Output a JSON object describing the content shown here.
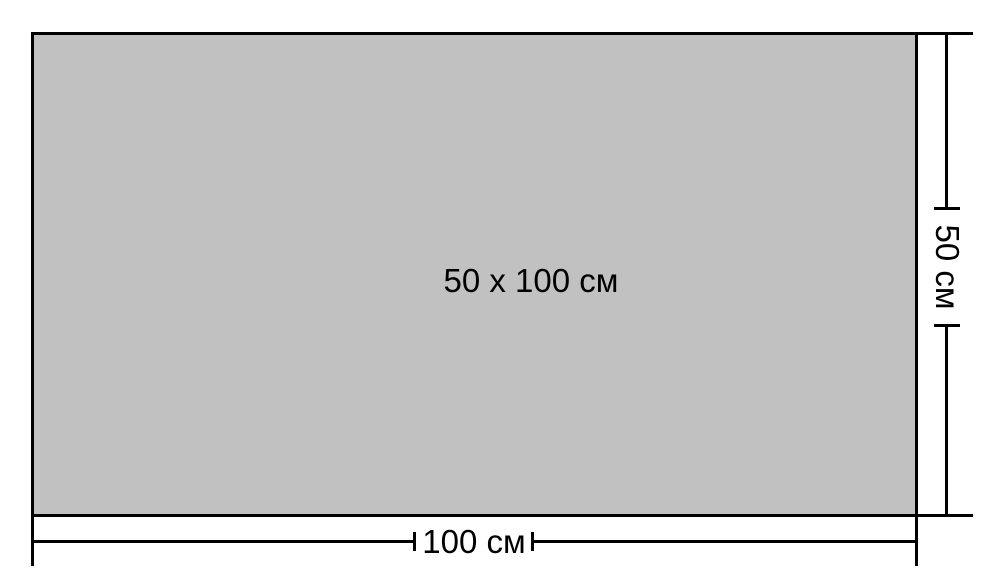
{
  "diagram": {
    "area_label": "50 x 100 см",
    "width_dimension": {
      "label": "100 см"
    },
    "height_dimension": {
      "label": "50 см"
    }
  },
  "colors": {
    "background": "#ffffff",
    "rectangle_fill": "#c1c1c1",
    "line": "#000000",
    "text": "#000000"
  }
}
